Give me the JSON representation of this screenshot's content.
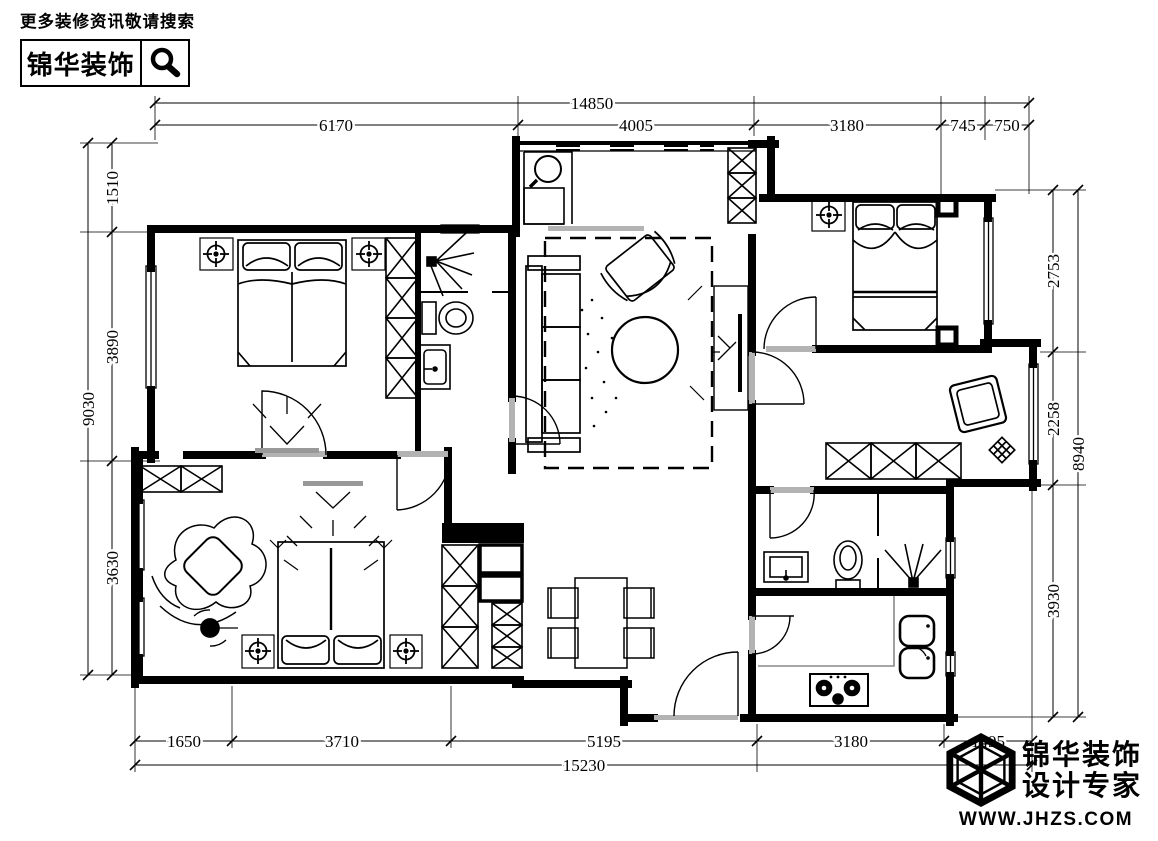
{
  "header": {
    "tagline": "更多装修资讯敬请搜索",
    "brand": "锦华装饰"
  },
  "footer": {
    "brand_top": "锦华装饰",
    "brand_bottom": "设计专家",
    "website": "WWW.JHZS.COM"
  },
  "icons": {
    "header_search": "magnifier",
    "footer_logo": "wireframe-cube"
  },
  "dimensions": {
    "top": {
      "overall": "14850",
      "segments": [
        "6170",
        "4005",
        "3180",
        "745",
        "750"
      ]
    },
    "bottom": {
      "overall": "15230",
      "segments": [
        "1650",
        "3710",
        "5195",
        "3180",
        "1495"
      ]
    },
    "left": {
      "overall": "9030",
      "segments": [
        "1510",
        "3890",
        "3630"
      ]
    },
    "right": {
      "overall": "8940",
      "segments": [
        "2753",
        "2258",
        "3930"
      ]
    }
  },
  "plan_symbols": [
    "double-bed",
    "wardrobe-x-hatch",
    "ceiling-lamp",
    "toilet",
    "washbasin",
    "shower-head",
    "sofa",
    "armchair",
    "round-tea-table",
    "tv-cabinet",
    "carpet-dashed",
    "dining-table",
    "dining-chairs",
    "gas-stove",
    "double-sink",
    "plant",
    "entrance-door"
  ],
  "colors": {
    "ink": "#000000",
    "paper": "#ffffff",
    "threshold_gray": "#b3b3b3"
  }
}
